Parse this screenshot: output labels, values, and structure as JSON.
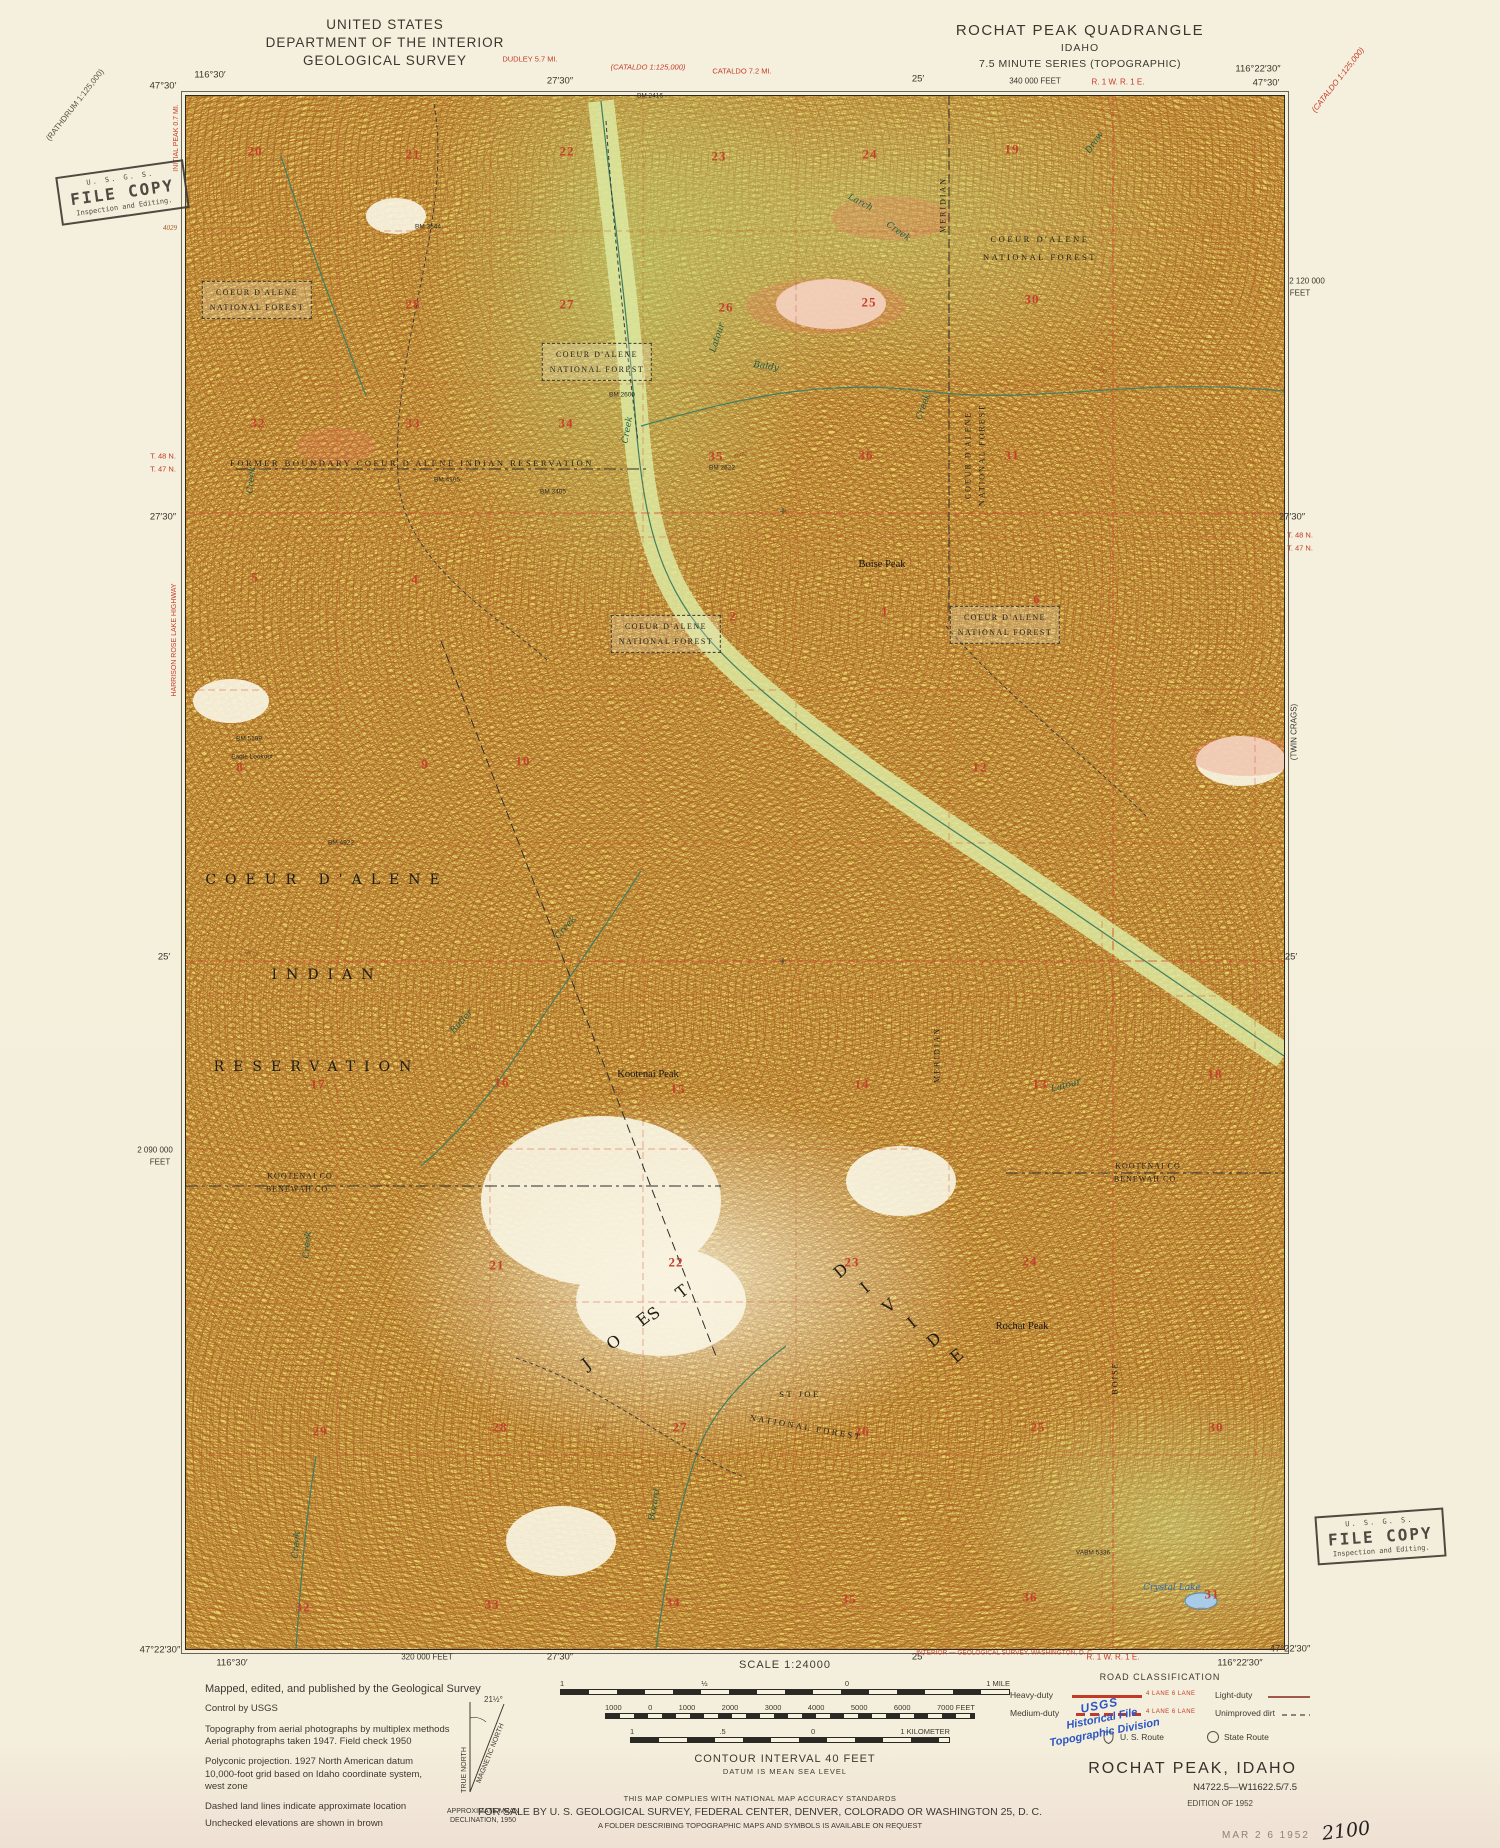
{
  "header": {
    "us_line1": "UNITED STATES",
    "us_line2": "DEPARTMENT OF THE INTERIOR",
    "us_line3": "GEOLOGICAL SURVEY",
    "quad_line1": "ROCHAT PEAK QUADRANGLE",
    "quad_line2": "IDAHO",
    "quad_line3": "7.5 MINUTE SERIES (TOPOGRAPHIC)"
  },
  "stamps": {
    "file_copy": {
      "agency": "U. S. G. S.",
      "title": "FILE COPY",
      "subtitle": "Inspection and Editing."
    },
    "blue": [
      "USGS",
      "Historical File",
      "Topographic Division"
    ]
  },
  "legend": {
    "lines": [
      "Mapped, edited, and published by the Geological Survey",
      "Control by USGS",
      "Topography from aerial photographs by multiplex methods",
      "Aerial photographs taken 1947.  Field check 1950",
      "Polyconic projection.  1927 North American datum",
      "10,000-foot grid based on Idaho coordinate system,",
      "west zone",
      "Dashed land lines indicate approximate location",
      "Unchecked elevations are shown in brown"
    ]
  },
  "declination": {
    "true_north": "TRUE NORTH",
    "magnetic_north": "MAGNETIC NORTH",
    "angle": "21½°",
    "caption1": "APPROXIMATE MEAN",
    "caption2": "DECLINATION, 1950"
  },
  "scale": {
    "title": "SCALE 1:24000",
    "miles_labels": [
      "1",
      "½",
      "0",
      "1 MILE"
    ],
    "feet_labels": [
      "1000",
      "0",
      "1000",
      "2000",
      "3000",
      "4000",
      "5000",
      "6000",
      "7000 FEET"
    ],
    "km_labels": [
      "1",
      ".5",
      "0",
      "1 KILOMETER"
    ],
    "contour": "CONTOUR INTERVAL 40 FEET",
    "datum": "DATUM IS MEAN SEA LEVEL"
  },
  "accuracy": {
    "line1": "THIS MAP COMPLIES WITH NATIONAL MAP ACCURACY STANDARDS",
    "line2": "FOR SALE BY U. S. GEOLOGICAL SURVEY, FEDERAL CENTER, DENVER, COLORADO OR WASHINGTON 25, D. C.",
    "line3": "A FOLDER DESCRIBING TOPOGRAPHIC MAPS AND SYMBOLS IS AVAILABLE ON REQUEST"
  },
  "road_classification": {
    "title": "ROAD CLASSIFICATION",
    "heavy": "Heavy-duty",
    "medium": "Medium-duty",
    "light": "Light-duty",
    "unimproved": "Unimproved dirt",
    "lanes": "4 LANE  6 LANE",
    "us_route": "U. S. Route",
    "state_route": "State Route"
  },
  "title_block": {
    "name": "ROCHAT PEAK, IDAHO",
    "number": "N4722.5—W11622.5/7.5",
    "edition": "EDITION OF 1952",
    "date_stamp": "MAR 2 6 1952",
    "handwritten": "2100"
  },
  "colors": {
    "paper": "#f4efdc",
    "map_base": "#e4d365",
    "contour": "#a96122",
    "grid_red": "#cf4a30",
    "water": "#3f7f60",
    "lake_fill": "#a8cce8",
    "stamp_blue": "#2b55c4"
  },
  "collar": {
    "labels": [
      {
        "t": "116°30′",
        "x": 210,
        "y": 76,
        "c": "cm"
      },
      {
        "t": "47°30′",
        "x": 163,
        "y": 87,
        "c": "cm"
      },
      {
        "t": "27′30″",
        "x": 560,
        "y": 82,
        "c": "cm"
      },
      {
        "t": "25′",
        "x": 918,
        "y": 80,
        "c": "cm"
      },
      {
        "t": "340 000 FEET",
        "x": 1035,
        "y": 81,
        "c": "cm",
        "s": 8
      },
      {
        "t": "116°22′30″",
        "x": 1258,
        "y": 70,
        "c": "cm"
      },
      {
        "t": "47°30′",
        "x": 1266,
        "y": 84,
        "c": "cm"
      },
      {
        "t": "47°22′30″",
        "x": 160,
        "y": 1651,
        "c": "cm"
      },
      {
        "t": "116°30′",
        "x": 232,
        "y": 1664,
        "c": "cm"
      },
      {
        "t": "320 000 FEET",
        "x": 427,
        "y": 1657,
        "c": "cm",
        "s": 8
      },
      {
        "t": "27′30″",
        "x": 560,
        "y": 1658,
        "c": "cm"
      },
      {
        "t": "25′",
        "x": 918,
        "y": 1658,
        "c": "cm"
      },
      {
        "t": "116°22′30″",
        "x": 1240,
        "y": 1664,
        "c": "cm"
      },
      {
        "t": "47°22′30″",
        "x": 1290,
        "y": 1650,
        "c": "cm"
      },
      {
        "t": "T. 48 N.",
        "x": 163,
        "y": 457,
        "c": "redm",
        "s": 7.5
      },
      {
        "t": "T. 47 N.",
        "x": 163,
        "y": 470,
        "c": "redm",
        "s": 7.5
      },
      {
        "t": "27′30″",
        "x": 163,
        "y": 518,
        "c": "cm"
      },
      {
        "t": "25′",
        "x": 164,
        "y": 958,
        "c": "cm"
      },
      {
        "t": "2 090 000",
        "x": 155,
        "y": 1150,
        "c": "cm",
        "s": 8
      },
      {
        "t": "FEET",
        "x": 160,
        "y": 1162,
        "c": "cm",
        "s": 8
      },
      {
        "t": "2 120 000",
        "x": 1307,
        "y": 281,
        "c": "cm",
        "s": 8
      },
      {
        "t": "FEET",
        "x": 1300,
        "y": 293,
        "c": "cm",
        "s": 8
      },
      {
        "t": "27′30″",
        "x": 1292,
        "y": 518,
        "c": "cm"
      },
      {
        "t": "T. 48 N.",
        "x": 1300,
        "y": 536,
        "c": "redm",
        "s": 7.5
      },
      {
        "t": "T. 47 N.",
        "x": 1300,
        "y": 549,
        "c": "redm",
        "s": 7.5
      },
      {
        "t": "(TWIN CRAGS)",
        "x": 1294,
        "y": 732,
        "c": "cm",
        "r": -90,
        "s": 8
      },
      {
        "t": "25′",
        "x": 1291,
        "y": 958,
        "c": "cm"
      },
      {
        "t": "DUDLEY 5.7 MI.",
        "x": 530,
        "y": 60,
        "c": "redm",
        "s": 7.5
      },
      {
        "t": "(CATALDO 1:125,000)",
        "x": 648,
        "y": 68,
        "c": "redmi",
        "s": 7.5
      },
      {
        "t": "CATALDO 7.2 MI.",
        "x": 742,
        "y": 72,
        "c": "redm",
        "s": 7.5
      },
      {
        "t": "R. 1 W. R. 1 E.",
        "x": 1118,
        "y": 82,
        "c": "redm",
        "s": 8
      },
      {
        "t": "(RATHDRUM 1:125,000)",
        "x": 75,
        "y": 105,
        "c": "diag",
        "r": -52,
        "s": 8
      },
      {
        "t": "(CATALDO 1:125,000)",
        "x": 1338,
        "y": 80,
        "c": "redmi",
        "r": -52,
        "s": 8
      },
      {
        "t": "INITIAL PEAK 0.7 MI.",
        "x": 177,
        "y": 138,
        "c": "redm",
        "r": -90,
        "s": 7
      },
      {
        "t": "HARRISON ROSE LAKE HIGHWAY",
        "x": 175,
        "y": 640,
        "c": "redm",
        "r": -90,
        "s": 7
      },
      {
        "t": "INTERIOR — GEOLOGICAL SURVEY, WASHINGTON, D. C.",
        "x": 1005,
        "y": 1653,
        "c": "redm",
        "s": 6.5
      },
      {
        "t": "R. 1 W. R. 1 E.",
        "x": 1113,
        "y": 1657,
        "c": "redm",
        "s": 8
      }
    ]
  },
  "map": {
    "labels": [
      {
        "t": "20",
        "x": 255,
        "y": 152,
        "c": "sec"
      },
      {
        "t": "21",
        "x": 413,
        "y": 155,
        "c": "sec"
      },
      {
        "t": "22",
        "x": 567,
        "y": 152,
        "c": "sec"
      },
      {
        "t": "23",
        "x": 719,
        "y": 157,
        "c": "sec"
      },
      {
        "t": "24",
        "x": 870,
        "y": 155,
        "c": "sec"
      },
      {
        "t": "19",
        "x": 1012,
        "y": 150,
        "c": "sec"
      },
      {
        "t": "28",
        "x": 413,
        "y": 305,
        "c": "sec"
      },
      {
        "t": "27",
        "x": 567,
        "y": 305,
        "c": "sec"
      },
      {
        "t": "26",
        "x": 726,
        "y": 308,
        "c": "sec"
      },
      {
        "t": "25",
        "x": 869,
        "y": 303,
        "c": "sec"
      },
      {
        "t": "30",
        "x": 1032,
        "y": 300,
        "c": "sec"
      },
      {
        "t": "32",
        "x": 258,
        "y": 424,
        "c": "sec"
      },
      {
        "t": "33",
        "x": 413,
        "y": 424,
        "c": "sec"
      },
      {
        "t": "34",
        "x": 566,
        "y": 424,
        "c": "sec"
      },
      {
        "t": "35",
        "x": 716,
        "y": 457,
        "c": "sec"
      },
      {
        "t": "36",
        "x": 866,
        "y": 456,
        "c": "sec"
      },
      {
        "t": "31",
        "x": 1012,
        "y": 456,
        "c": "sec"
      },
      {
        "t": "5",
        "x": 255,
        "y": 578,
        "c": "sec"
      },
      {
        "t": "4",
        "x": 415,
        "y": 580,
        "c": "sec"
      },
      {
        "t": "2",
        "x": 733,
        "y": 617,
        "c": "sec"
      },
      {
        "t": "1",
        "x": 885,
        "y": 612,
        "c": "sec"
      },
      {
        "t": "6",
        "x": 1037,
        "y": 600,
        "c": "sec"
      },
      {
        "t": "8",
        "x": 240,
        "y": 768,
        "c": "sec"
      },
      {
        "t": "9",
        "x": 425,
        "y": 765,
        "c": "sec"
      },
      {
        "t": "10",
        "x": 523,
        "y": 762,
        "c": "sec"
      },
      {
        "t": "12",
        "x": 980,
        "y": 768,
        "c": "sec"
      },
      {
        "t": "17",
        "x": 318,
        "y": 1085,
        "c": "sec"
      },
      {
        "t": "16",
        "x": 502,
        "y": 1083,
        "c": "sec"
      },
      {
        "t": "15",
        "x": 678,
        "y": 1090,
        "c": "sec"
      },
      {
        "t": "14",
        "x": 862,
        "y": 1085,
        "c": "sec"
      },
      {
        "t": "13",
        "x": 1040,
        "y": 1085,
        "c": "sec"
      },
      {
        "t": "18",
        "x": 1215,
        "y": 1075,
        "c": "sec"
      },
      {
        "t": "21",
        "x": 497,
        "y": 1266,
        "c": "sec"
      },
      {
        "t": "22",
        "x": 676,
        "y": 1263,
        "c": "sec"
      },
      {
        "t": "23",
        "x": 852,
        "y": 1263,
        "c": "sec"
      },
      {
        "t": "24",
        "x": 1030,
        "y": 1262,
        "c": "sec"
      },
      {
        "t": "29",
        "x": 320,
        "y": 1432,
        "c": "sec"
      },
      {
        "t": "28",
        "x": 500,
        "y": 1428,
        "c": "sec"
      },
      {
        "t": "27",
        "x": 680,
        "y": 1428,
        "c": "sec"
      },
      {
        "t": "26",
        "x": 862,
        "y": 1432,
        "c": "sec"
      },
      {
        "t": "25",
        "x": 1038,
        "y": 1428,
        "c": "sec"
      },
      {
        "t": "30",
        "x": 1216,
        "y": 1428,
        "c": "sec"
      },
      {
        "t": "32",
        "x": 303,
        "y": 1608,
        "c": "sec"
      },
      {
        "t": "33",
        "x": 492,
        "y": 1605,
        "c": "sec"
      },
      {
        "t": "34",
        "x": 673,
        "y": 1603,
        "c": "sec"
      },
      {
        "t": "35",
        "x": 849,
        "y": 1600,
        "c": "sec"
      },
      {
        "t": "36",
        "x": 1030,
        "y": 1598,
        "c": "sec"
      },
      {
        "t": "31",
        "x": 1212,
        "y": 1595,
        "c": "sec"
      },
      {
        "t": "COEUR D'ALENE|NATIONAL FOREST",
        "x": 257,
        "y": 300,
        "c": "fbox"
      },
      {
        "t": "COEUR D'ALENE|NATIONAL FOREST",
        "x": 597,
        "y": 362,
        "c": "fbox"
      },
      {
        "t": "COEUR D'ALENE|NATIONAL FOREST",
        "x": 666,
        "y": 634,
        "c": "fbox"
      },
      {
        "t": "COEUR D'ALENE|NATIONAL FOREST",
        "x": 1005,
        "y": 625,
        "c": "fbox"
      },
      {
        "t": "COEUR D'ALENE",
        "x": 1040,
        "y": 240,
        "c": "forest"
      },
      {
        "t": "NATIONAL FOREST",
        "x": 1040,
        "y": 258,
        "c": "forest"
      },
      {
        "t": "FORMER BOUNDARY   COEUR D'ALENE   INDIAN   RESERVATION",
        "x": 412,
        "y": 464,
        "c": "forest"
      },
      {
        "t": "COEUR D'ALENE",
        "x": 327,
        "y": 880,
        "c": "big"
      },
      {
        "t": "INDIAN",
        "x": 327,
        "y": 975,
        "c": "big"
      },
      {
        "t": "RESERVATION",
        "x": 317,
        "y": 1067,
        "c": "big"
      },
      {
        "t": "S T",
        "x": 672,
        "y": 1300,
        "c": "big2",
        "r": -38
      },
      {
        "t": "J O E",
        "x": 620,
        "y": 1338,
        "c": "big2",
        "r": -38
      },
      {
        "t": "D",
        "x": 845,
        "y": 1268,
        "c": "big2",
        "r": -40
      },
      {
        "t": "I",
        "x": 869,
        "y": 1285,
        "c": "big2",
        "r": -40
      },
      {
        "t": "V",
        "x": 893,
        "y": 1303,
        "c": "big2",
        "r": -40
      },
      {
        "t": "I",
        "x": 916,
        "y": 1320,
        "c": "big2",
        "r": -40
      },
      {
        "t": "D",
        "x": 938,
        "y": 1337,
        "c": "big2",
        "r": -40
      },
      {
        "t": "E",
        "x": 961,
        "y": 1353,
        "c": "big2",
        "r": -40
      },
      {
        "t": "ST JOE",
        "x": 800,
        "y": 1395,
        "c": "forest"
      },
      {
        "t": "NATIONAL FOREST",
        "x": 806,
        "y": 1428,
        "c": "forest",
        "r": 10
      },
      {
        "t": "KOOTENAI CO",
        "x": 300,
        "y": 1176,
        "c": "cnty"
      },
      {
        "t": "BENEWAH CO",
        "x": 297,
        "y": 1189,
        "c": "cnty"
      },
      {
        "t": "KOOTENAI CO",
        "x": 1148,
        "y": 1166,
        "c": "cnty"
      },
      {
        "t": "BENEWAH CO",
        "x": 1145,
        "y": 1179,
        "c": "cnty"
      },
      {
        "t": "Boise Peak",
        "x": 882,
        "y": 565,
        "c": "place"
      },
      {
        "t": "Kootenai Peak",
        "x": 648,
        "y": 1075,
        "c": "place"
      },
      {
        "t": "Rochat Peak",
        "x": 1022,
        "y": 1327,
        "c": "place"
      },
      {
        "t": "Eagle Lookout",
        "x": 252,
        "y": 757,
        "c": "bm"
      },
      {
        "t": "5464",
        "x": 616,
        "y": 1092,
        "c": "elev"
      },
      {
        "t": "5643",
        "x": 997,
        "y": 1342,
        "c": "elev"
      },
      {
        "t": "BM 2416",
        "x": 650,
        "y": 96,
        "c": "bm"
      },
      {
        "t": "BM 3544",
        "x": 428,
        "y": 227,
        "c": "bm"
      },
      {
        "t": "BM 2600",
        "x": 622,
        "y": 395,
        "c": "bm"
      },
      {
        "t": "BM 4105",
        "x": 447,
        "y": 480,
        "c": "bm"
      },
      {
        "t": "BM 3405",
        "x": 553,
        "y": 492,
        "c": "bm"
      },
      {
        "t": "BM 2622",
        "x": 722,
        "y": 468,
        "c": "bm"
      },
      {
        "t": "BM 4922",
        "x": 341,
        "y": 843,
        "c": "bm"
      },
      {
        "t": "BM 5199",
        "x": 249,
        "y": 739,
        "c": "bm"
      },
      {
        "t": "VABM 5336",
        "x": 1093,
        "y": 1553,
        "c": "bm"
      },
      {
        "t": "Latour",
        "x": 718,
        "y": 338,
        "c": "creek",
        "r": -72
      },
      {
        "t": "Creek",
        "x": 628,
        "y": 430,
        "c": "creek",
        "r": -80
      },
      {
        "t": "Larch",
        "x": 860,
        "y": 203,
        "c": "creek",
        "r": 28
      },
      {
        "t": "Creek",
        "x": 898,
        "y": 232,
        "c": "creek",
        "r": 35
      },
      {
        "t": "Baldy",
        "x": 766,
        "y": 367,
        "c": "creek",
        "r": 8
      },
      {
        "t": "Creek",
        "x": 924,
        "y": 407,
        "c": "creek",
        "r": -70
      },
      {
        "t": "Butler",
        "x": 462,
        "y": 1022,
        "c": "creek",
        "r": -48
      },
      {
        "t": "Creek",
        "x": 566,
        "y": 928,
        "c": "creek",
        "r": -48
      },
      {
        "t": "Latour",
        "x": 1066,
        "y": 1086,
        "c": "creek",
        "r": -15
      },
      {
        "t": "Creek",
        "x": 252,
        "y": 480,
        "c": "creek",
        "r": -85
      },
      {
        "t": "Creek",
        "x": 308,
        "y": 1245,
        "c": "creek",
        "r": -85
      },
      {
        "t": "Creek",
        "x": 297,
        "y": 1545,
        "c": "creek",
        "r": -85
      },
      {
        "t": "Bozard",
        "x": 655,
        "y": 1505,
        "c": "creek",
        "r": -80
      },
      {
        "t": "Draw",
        "x": 1095,
        "y": 143,
        "c": "creek",
        "r": -55
      },
      {
        "t": "Crystal Lake",
        "x": 1172,
        "y": 1588,
        "c": "lake"
      },
      {
        "t": "MERIDIAN",
        "x": 943,
        "y": 205,
        "c": "vert",
        "r": -90
      },
      {
        "t": "MERIDIAN",
        "x": 937,
        "y": 1055,
        "c": "vert",
        "r": -90
      },
      {
        "t": "BOISE",
        "x": 1115,
        "y": 1378,
        "c": "vert",
        "r": -90
      },
      {
        "t": "COEUR D'ALENE",
        "x": 968,
        "y": 455,
        "c": "vert",
        "r": -90
      },
      {
        "t": "NATIONAL FOREST",
        "x": 982,
        "y": 455,
        "c": "vert",
        "r": -90
      },
      {
        "t": "4600",
        "x": 740,
        "y": 455,
        "c": "elev",
        "r": -20
      },
      {
        "t": "3800",
        "x": 1100,
        "y": 370,
        "c": "elev",
        "r": 20
      },
      {
        "t": "5000",
        "x": 470,
        "y": 1048,
        "c": "elev",
        "r": -10
      },
      {
        "t": "4800",
        "x": 250,
        "y": 953,
        "c": "elev",
        "r": 15
      },
      {
        "t": "3400",
        "x": 600,
        "y": 1428,
        "c": "elev",
        "r": -25
      },
      {
        "t": "6099",
        "x": 1208,
        "y": 712,
        "c": "elev"
      },
      {
        "t": "4029",
        "x": 170,
        "y": 228,
        "c": "elev"
      },
      {
        "t": "+",
        "x": 783,
        "y": 512,
        "c": "cross"
      },
      {
        "t": "+",
        "x": 783,
        "y": 962,
        "c": "cross"
      }
    ]
  }
}
